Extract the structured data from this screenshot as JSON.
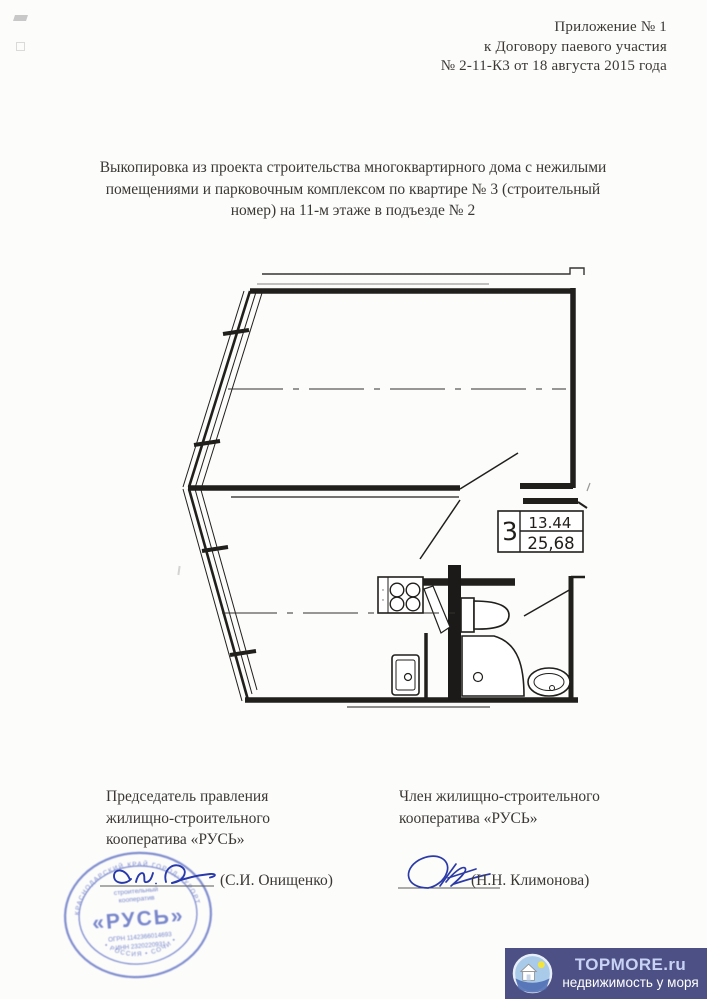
{
  "header": {
    "line1": "Приложение № 1",
    "line2": "к Договору паевого участия",
    "line3": "№ 2-11-К3 от 18 августа 2015 года"
  },
  "paragraph": {
    "line1": "Выкопировка из проекта строительства многоквартирного дома с нежилыми",
    "line2": "помещениями и парковочным комплексом по квартире № 3 (строительный",
    "line3": "номер) на 11-м этаже в подъезде № 2"
  },
  "floor_plan": {
    "unit_number": "3",
    "living_area": "13.44",
    "total_area": "25,68"
  },
  "signatures": {
    "left": {
      "title_lines": [
        "Председатель правления",
        "жилищно-строительного",
        "кооператива «РУСЬ»"
      ],
      "name": "(С.И. Онищенко)"
    },
    "right": {
      "title_lines": [
        "Член жилищно-строительного",
        "кооператива «РУСЬ»"
      ],
      "name": "(Н.Н. Климонова)"
    }
  },
  "stamp": {
    "ring_top": "КРАСНОДАРСКИЙ КРАЙ ГОРОД-КУРОРТ",
    "ring_bottom": "• РОССИЯ • СОЧИ •",
    "center_line1": "строительный",
    "center_line2": "кооператив",
    "center_name": "«РУСЬ»",
    "ogrn": "ОГРН 1142366014693",
    "inn": "ИНН 2320220931",
    "ink_color": "#5b6cc0"
  },
  "watermark": {
    "title": "TOPMORE.ru",
    "subtitle": "недвижимость у моря",
    "bg_color": "#4d5084",
    "title_color": "#c8d2f4",
    "subtitle_color": "#ffffff"
  },
  "colors": {
    "paper": "#fcfcfb",
    "ink": "#34312c",
    "plan_ink": "#211f1c",
    "signature_ink": "#2839ac"
  }
}
